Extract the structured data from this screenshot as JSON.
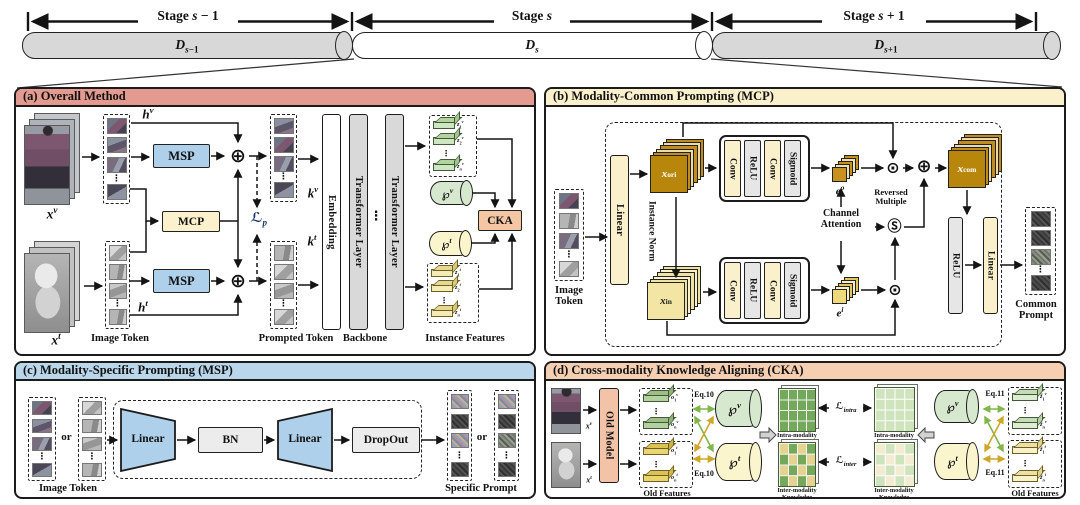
{
  "colors": {
    "panel_a_header": "#e39a91",
    "panel_b_header": "#fbf0cc",
    "panel_c_header": "#b9d6ea",
    "panel_d_header": "#f6cfb2",
    "msp_box": "#aed0ea",
    "mcp_box": "#fbf1cd",
    "cka_box": "#f4c6a4",
    "transformer_bar": "#d9d9d9",
    "linear_bar": "#fbf0cc",
    "relu_bar": "#e6e6e6",
    "visible_prompt_pool": "#d6e9cf",
    "infrared_prompt_pool": "#fbf5cd",
    "gold_feature": "#b8860b",
    "light_gold_feature": "#f3e5a3",
    "old_model_bar": "#f2c3a7",
    "dataset_cylinder": "#d8d8d8",
    "green_arrow": "#82b54b",
    "yellow_arrow": "#cda62a"
  },
  "timeline": {
    "stages": [
      {
        "label": "Stage *s* − 1",
        "dataset": "*D*_{*s*−1}"
      },
      {
        "label": "Stage *s*",
        "dataset": "*D*_{*s*}"
      },
      {
        "label": "Stage *s* + 1",
        "dataset": "*D*_{*s*+1}"
      }
    ]
  },
  "panel_a": {
    "title": "(a) Overall Method",
    "xv": "*x*^{*v*}",
    "xt": "*x*^{*t*}",
    "hv": "*h*^{*v*}",
    "ht": "*h*^{*t*}",
    "kv": "*k*^{*v*}",
    "kt": "*k*^{*t*}",
    "msp": "MSP",
    "mcp": "MCP",
    "lp": "ℒ_{*p*}",
    "plus": "⊕",
    "dots": "⋮",
    "image_token": "Image Token",
    "prompted_token": "Prompted Token",
    "backbone": "Backbone",
    "instance_features": "Instance Features",
    "embedding": "Embedding",
    "transformer": "Transformer Layer",
    "pv": "℘^{*v*}",
    "pt": "℘^{*t*}",
    "cka": "CKA",
    "zv": [
      "*z*_{1}^{*v*}",
      "*z*_{2}^{*v*}",
      "*z*_{*n*}^{*v*}"
    ],
    "zt": [
      "*z*_{1}^{*t*}",
      "*z*_{2}^{*t*}",
      "*z*_{*n*}^{*t*}"
    ]
  },
  "panel_b": {
    "title": "(b) Modality-Common Prompting (MCP)",
    "image_token": "Image Token",
    "linear": "Linear",
    "instance_norm": "Instance Norm",
    "x_ori": "*x*_{ori}",
    "x_in": "*x*_{in}",
    "x_com": "*x*_{com}",
    "conv": "Conv",
    "relu": "ReLU",
    "sigmoid": "Sigmoid",
    "eo": "*e*^{*o*}",
    "ei": "*e*^{*i*}",
    "channel_attention": "Channel Attention",
    "reversed_multiple": "Reversed Multiple",
    "odot": "⊙",
    "oplus": "⊕",
    "reversed_symbol": "Ⓢ",
    "dots": "⋮",
    "common_prompt": "Common Prompt"
  },
  "panel_c": {
    "title": "(c) Modality-Specific Prompting (MSP)",
    "or": "or",
    "image_token": "Image Token",
    "linear": "Linear",
    "bn": "BN",
    "dropout": "DropOut",
    "specific_prompt": "Specific Prompt",
    "dots": "⋮"
  },
  "panel_d": {
    "title": "(d) Cross-modality Knowledge Aligning (CKA)",
    "xv": "*x*^{*v*}",
    "xt": "*x*^{*t*}",
    "old_model": "Old Model",
    "old_features": "Old Features",
    "ov": [
      "*o*_{1}^{*v*}",
      "*o*_{*n*}^{*v*}"
    ],
    "ot": [
      "*o*_{1}^{*t*}",
      "*o*_{*n*}^{*t*}"
    ],
    "zv": [
      "*z̃*_{1}^{*v*}",
      "*z̃*_{*n*}^{*v*}"
    ],
    "zt": [
      "*z̃*_{1}^{*t*}",
      "*z̃*_{*n*}^{*t*}"
    ],
    "eq10": "Eq.10",
    "eq11": "Eq.11",
    "pv": "℘^{*v*}",
    "pt": "℘^{*t*}",
    "l_intra": "ℒ_{*intra*}",
    "l_inter": "ℒ_{*inter*}",
    "dots": "⋮",
    "intra_knowledge": "Intra-modality Knowledge",
    "inter_knowledge": "Inter-modality Knowledge"
  }
}
